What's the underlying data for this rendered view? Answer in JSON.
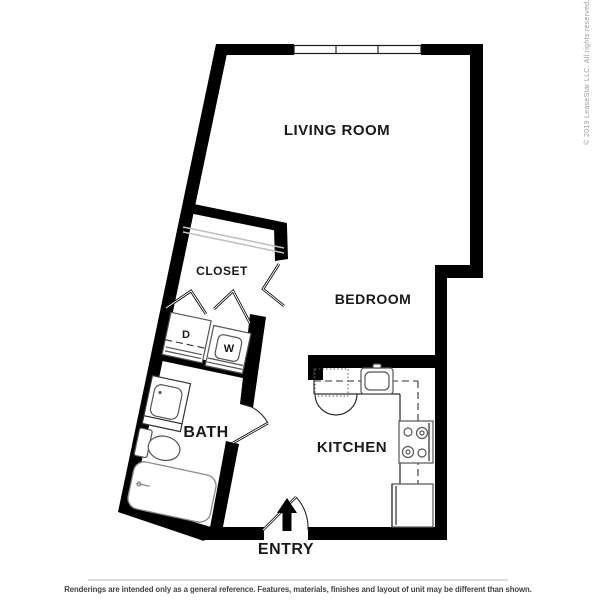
{
  "floorplan": {
    "labels": {
      "living_room": "LIVING ROOM",
      "bedroom": "BEDROOM",
      "closet": "CLOSET",
      "bath": "BATH",
      "kitchen": "KITCHEN",
      "entry": "ENTRY",
      "dryer": "D",
      "washer": "W"
    }
  },
  "watermark": {
    "copyright": "© 2019 LeaseStar LLC. All rights reserved."
  },
  "footer": {
    "disclaimer": "Renderings are intended only as a general reference. Features, materials, finishes and layout of unit may be different than shown."
  },
  "colors": {
    "walls": "#000000",
    "fixture_lines": "#555555",
    "tub_lines": "#8a8a8a",
    "closet_shelf": "#c0c0c0",
    "watermark_text": "#9b9b9b",
    "disclaimer_text": "#444444",
    "divider_rule": "#bbbbbb",
    "background": "#ffffff"
  }
}
